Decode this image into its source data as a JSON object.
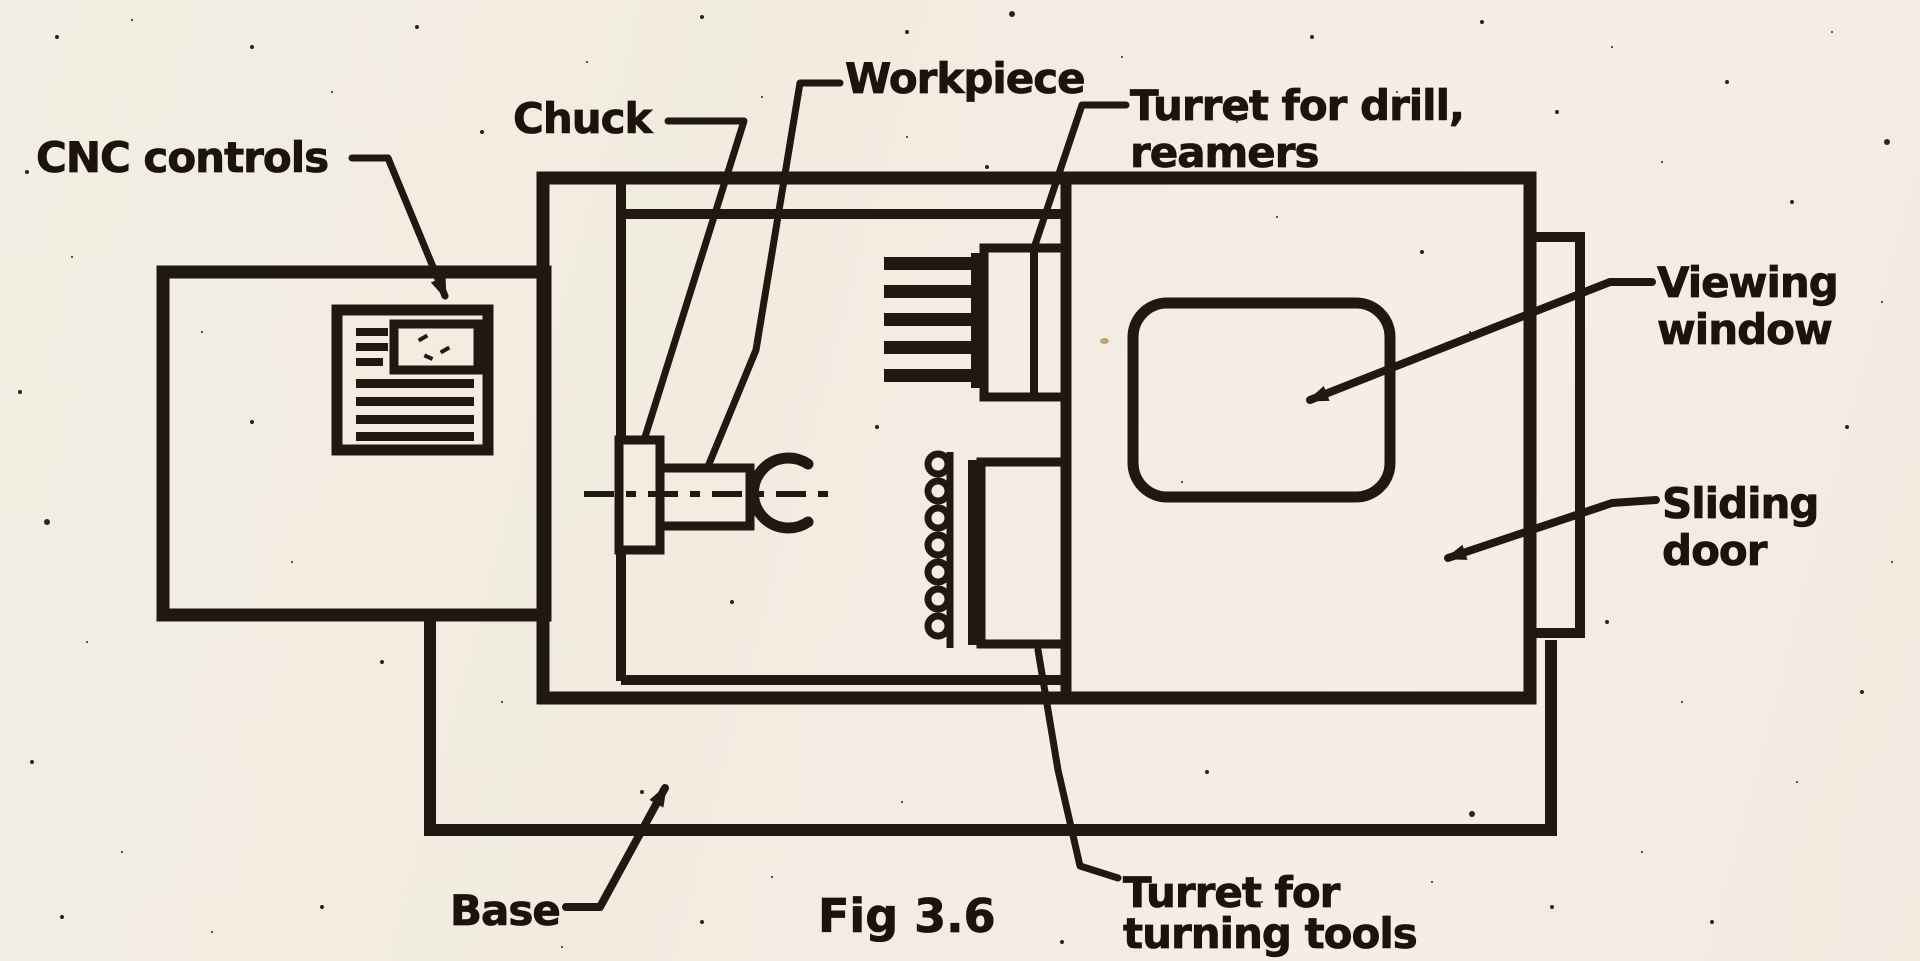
{
  "figure": {
    "caption": "Fig 3.6"
  },
  "colors": {
    "ink": "#211911",
    "paper": "#f2ede2"
  },
  "labels": {
    "cnc_controls": "CNC controls",
    "chuck": "Chuck",
    "workpiece": "Workpiece",
    "turret_drill_line1": "Turret for drill,",
    "turret_drill_line2": "reamers",
    "viewing_line1": "Viewing",
    "viewing_line2": "window",
    "sliding_line1": "Sliding",
    "sliding_line2": "door",
    "base": "Base",
    "turret_turning_line1": "Turret for",
    "turret_turning_line2": "turning tools"
  }
}
